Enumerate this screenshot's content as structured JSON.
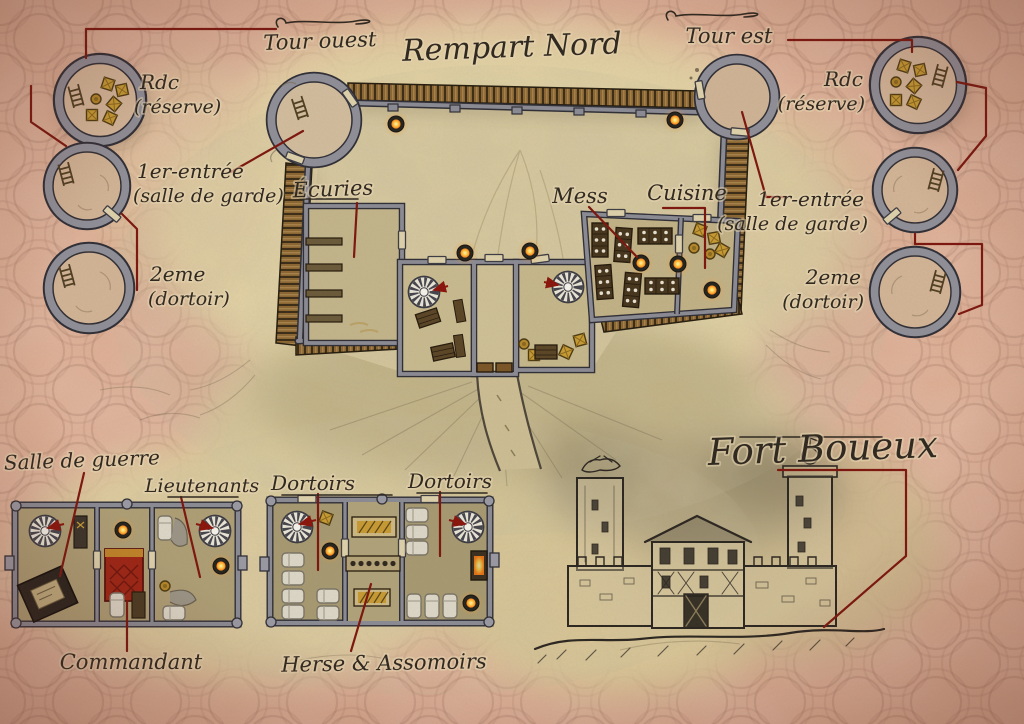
{
  "fort_title": "Fort Boueux",
  "palette": {
    "parchment_pink": "#d9a78d",
    "parchment_tan": "#e3d4a8",
    "ink": "#2d271f",
    "leader_red": "#7c150d",
    "wall_gray": "#8b8b95",
    "wood_brown": "#8a6632",
    "gold": "#c79b33",
    "flame_orange": "#ff9a2a",
    "commander_red": "#9e2414"
  },
  "north_rampart": {
    "label": "Rempart Nord",
    "west_tower_label": "Tour ouest",
    "east_tower_label": "Tour est"
  },
  "courtyard_rooms": {
    "stables": "Écuries",
    "mess_hall": "Mess",
    "kitchen": "Cuisine"
  },
  "west_tower_floors": [
    {
      "name": "Rdc",
      "detail": "(réserve)"
    },
    {
      "name": "1er-entrée",
      "detail": "(salle de garde)"
    },
    {
      "name": "2eme",
      "detail": "(dortoir)"
    }
  ],
  "east_tower_floors": [
    {
      "name": "Rdc",
      "detail": "(réserve)"
    },
    {
      "name": "1er-entrée",
      "detail": "(salle de garde)"
    },
    {
      "name": "2eme",
      "detail": "(dortoir)"
    }
  ],
  "command_building": {
    "war_room": "Salle de guerre",
    "lieutenants_room": "Lieutenants",
    "commander_room": "Commandant"
  },
  "dormitory_building": {
    "left_dorm": "Dortoirs",
    "right_dorm": "Dortoirs",
    "defenses": "Herse & Assomoirs"
  }
}
